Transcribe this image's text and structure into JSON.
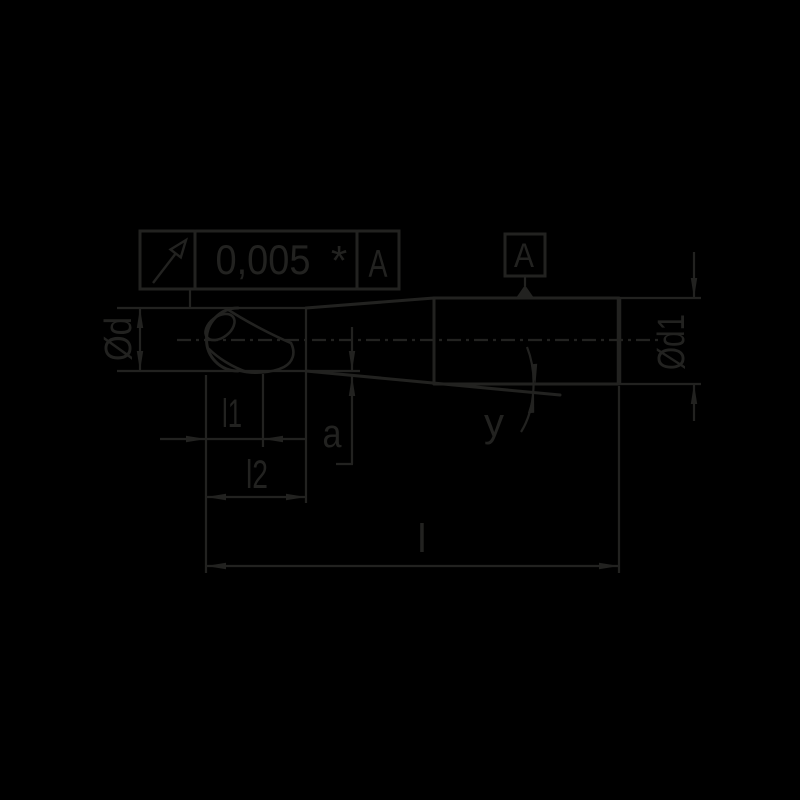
{
  "drawing": {
    "title": "tapered-ball-nose-end-mill-dimension-drawing",
    "colors": {
      "background": "#000000",
      "ink": "#222220"
    },
    "tolerance_frame": {
      "symbol_icon": "circular-runout-arrow",
      "value": "0,005",
      "note": "*",
      "datum_ref": "A"
    },
    "datum_flag": {
      "label": "A"
    },
    "labels": {
      "diameter_head": "Ød",
      "diameter_shank": "Ød1",
      "flute_length": "l1",
      "cut_length": "l2",
      "clearance": "a",
      "overall_length": "l",
      "taper_angle": "y"
    }
  }
}
